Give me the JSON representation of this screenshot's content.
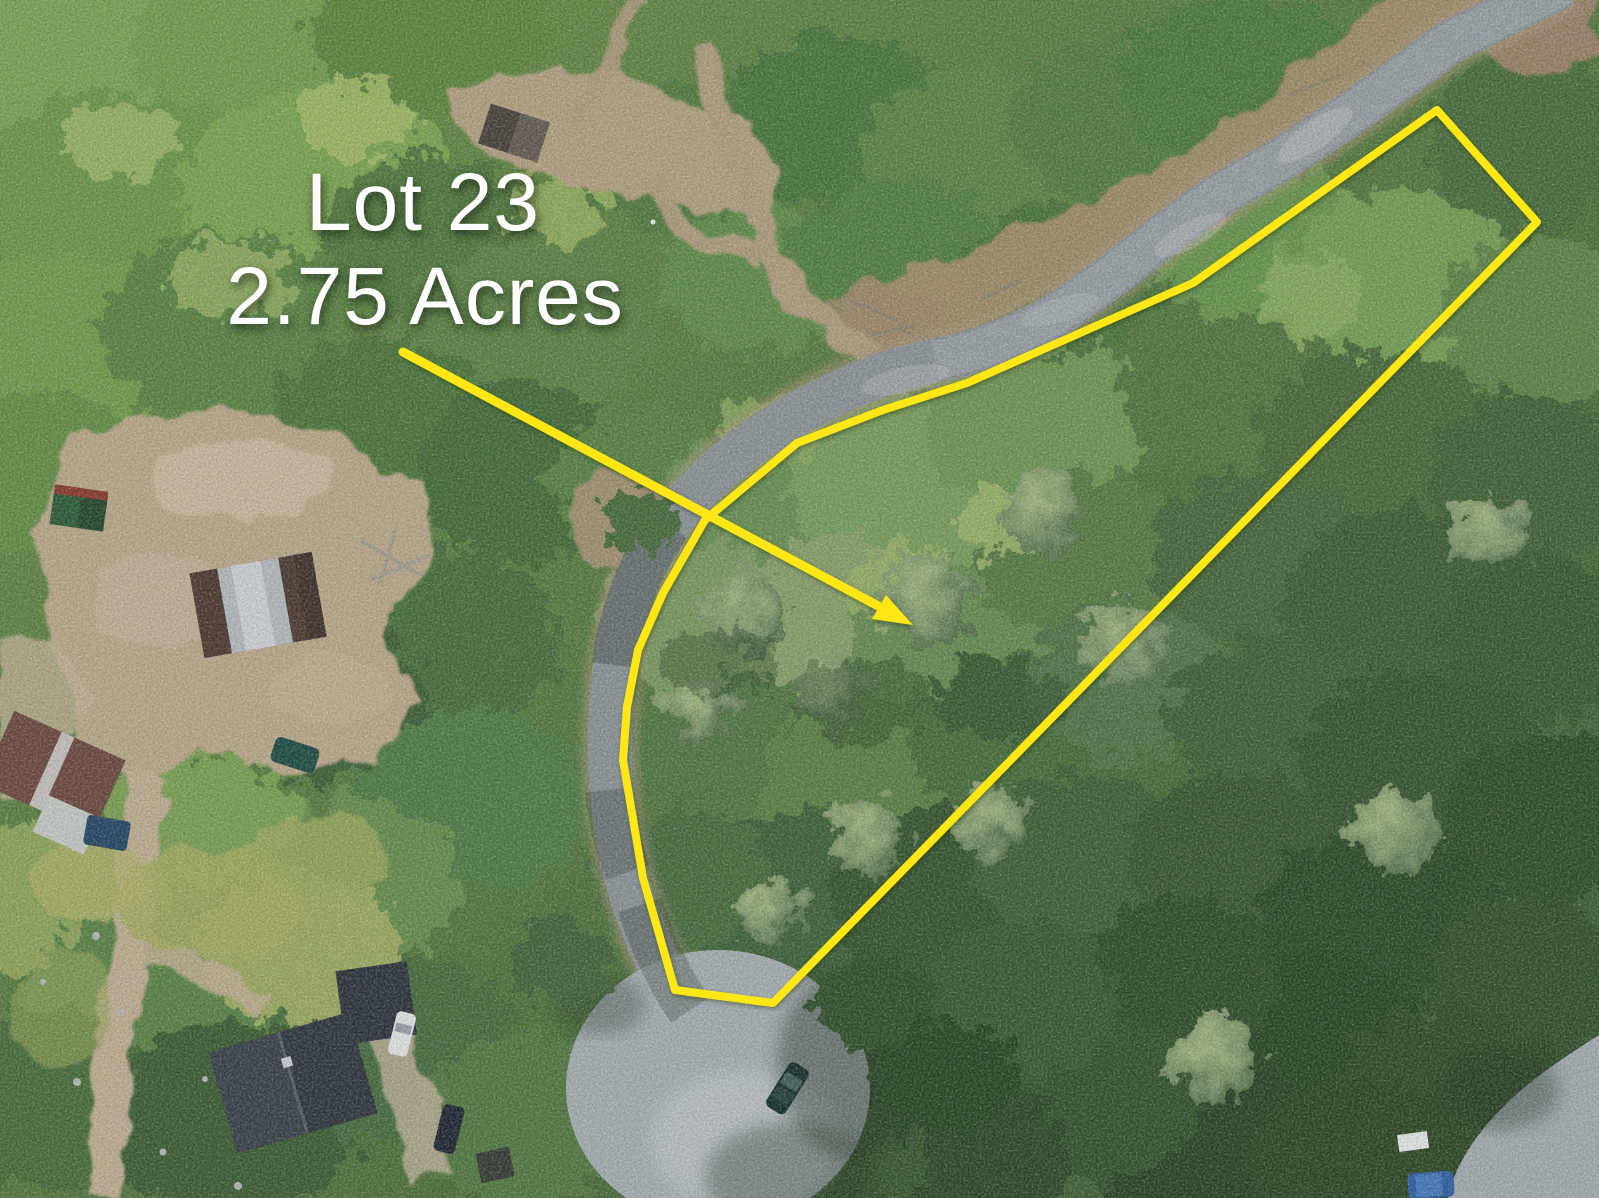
{
  "photo": {
    "kind": "aerial drone photograph",
    "subject": "Wooded building lot outlined in yellow along a paved road ending in a cul-de-sac, surrounded by forest, dirt driveways and neighboring houses",
    "overlay": {
      "line1": "Lot 23",
      "line2": "2.75 Acres",
      "text_color": "#ffffff",
      "highlight_color": "#ffe712",
      "lot_outline_points": "1437,110 1537,222 773,1003 675,990 643,878 623,760 627,707 638,650 663,593 705,520 797,443 883,410 967,383 1193,283",
      "arrow_line_path": "M403,352 L882,608",
      "arrow_head_points": "913,625 872,619 886,595"
    },
    "visible_features": [
      "paved road from top right to cul-de-sac",
      "cul-de-sac with parked dark green car",
      "dirt clearing and winding dirt road at top left",
      "large dirt yard with barn (brown and silver roof)",
      "small green-roof shed",
      "small dark shed at top",
      "brown-roof house at far left with blue pool",
      "gray-roof house at bottom left with white car and dark car",
      "gravel driveway running down left edge",
      "paved area with blue car and white sign at bottom right",
      "dense mixed green forest"
    ]
  }
}
